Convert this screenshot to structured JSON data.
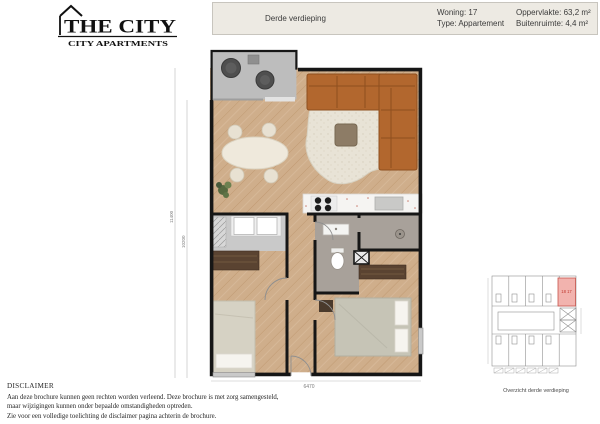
{
  "logo": {
    "title": "THE CITY",
    "subtitle": "CITY APARTMENTS"
  },
  "header": {
    "floor_label": "Derde verdieping",
    "unit_label": "Woning: 17",
    "type_label": "Type: Appartement",
    "area_label": "Oppervlakte: 63,2 m²",
    "outdoor_label": "Buitenruimte: 4,4 m²"
  },
  "plan": {
    "dim_width": "6470",
    "dim_height_outer": "11400",
    "dim_height_inner": "10200"
  },
  "overview": {
    "caption": "Overzicht derde verdieping",
    "highlight_label": "18 17"
  },
  "disclaimer": {
    "heading": "DISCLAIMER",
    "line1": "Aan deze brochure kunnen geen rechten worden verleend. Deze brochure is met zorg samengesteld,",
    "line2": "maar wijzigingen kunnen onder bepaalde omstandigheden optreden.",
    "line3": "Zie voor een volledige toelichting de disclaimer pagina achterin de brochure."
  },
  "colors": {
    "wall": "#161616",
    "floor": "#cfae8b",
    "balcony": "#bdbdbd",
    "sofa": "#b2672e",
    "bathroom": "#a8a19a",
    "highlight": "#f2b3ae",
    "accent_red": "#c0392f",
    "header_bg": "#edeae3"
  }
}
